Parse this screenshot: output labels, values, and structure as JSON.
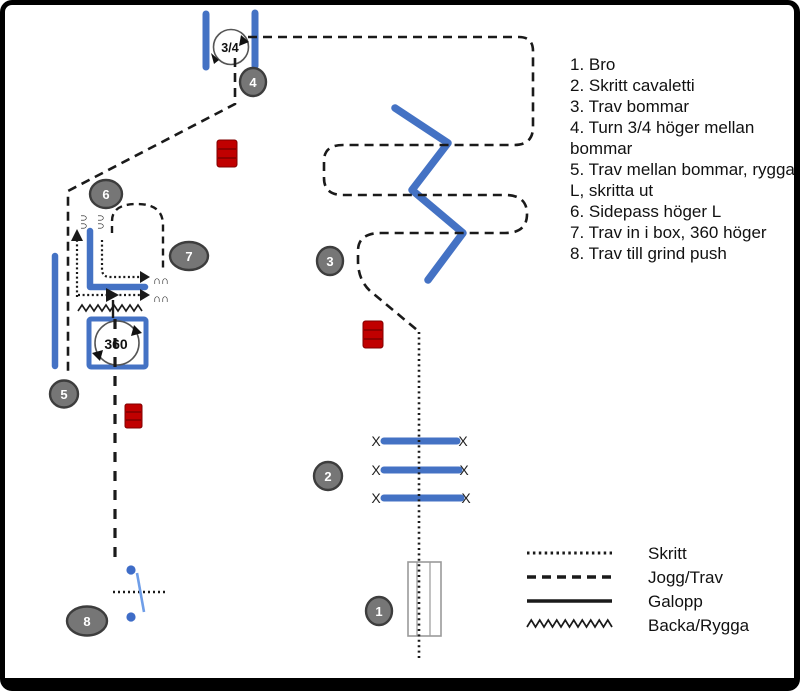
{
  "instructions": {
    "items": [
      "1. Bro",
      "2. Skritt cavaletti",
      "3. Trav bommar",
      "4. Turn 3/4 höger mellan bommar",
      "5. Trav mellan bommar, rygga L, skritta ut",
      "6. Sidepass höger L",
      "7. Trav in i box, 360 höger",
      "8. Trav till grind push"
    ]
  },
  "legend": {
    "items": [
      {
        "label": "Skritt",
        "style": "dotted"
      },
      {
        "label": "Jogg/Trav",
        "style": "dashed"
      },
      {
        "label": "Galopp",
        "style": "solid"
      },
      {
        "label": "Backa/Rygga",
        "style": "zigzag"
      }
    ]
  },
  "markers": [
    "1",
    "2",
    "3",
    "4",
    "5",
    "6",
    "7",
    "8"
  ],
  "symbols": {
    "turn34": "3/4",
    "turn360": "360",
    "cavaletti_end": "X",
    "hoof_pair": "∩∩"
  },
  "colors": {
    "pole_blue": "#4472C4",
    "gate_blue": "#6f9ee8",
    "barrel_red": "#C00000",
    "barrel_dark": "#7f0000",
    "marker_gray": "#767676",
    "marker_border": "#3d3d3d",
    "path_black": "#1a1a1a"
  }
}
